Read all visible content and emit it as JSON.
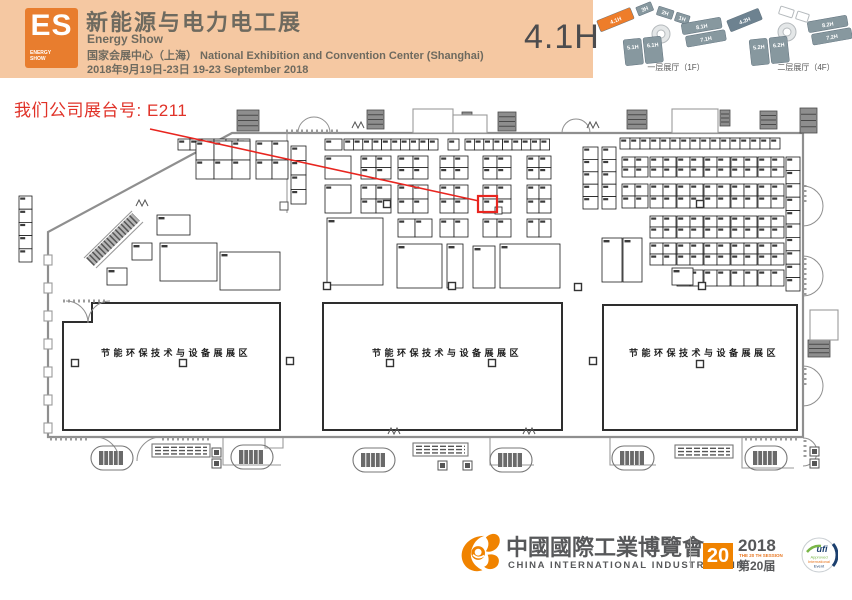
{
  "header": {
    "logo": {
      "es": "ES",
      "energy": "ENERGY",
      "show": "SHOW"
    },
    "title_cn": "新能源与电力电工展",
    "title_en": "Energy Show",
    "venue": "国家会展中心（上海） National Exhibition and Convention Center (Shanghai)",
    "dates": "2018年9月19日-23日    19-23 September 2018",
    "hall": "4.1H",
    "minimap1": {
      "label": "一层展厅（1F）",
      "h1": "1H",
      "h2": "2H",
      "h3": "3H",
      "h41": "4.1H",
      "h51": "5.1H",
      "h61": "6.1H",
      "h71": "7.1H",
      "h81": "8.1H"
    },
    "minimap2": {
      "label": "二层展厅（4F）",
      "h42": "4.2H",
      "h52": "5.2H",
      "h62": "6.2H",
      "h72": "7.2H",
      "h82": "8.2H"
    }
  },
  "annotation": {
    "text": "我们公司展台号: E211",
    "booth": "E211"
  },
  "map": {
    "zone_label": "节能环保技术与设备展展区",
    "grids": [
      [
        178,
        139,
        6,
        1,
        12,
        11
      ],
      [
        325,
        139,
        1,
        1,
        17,
        11
      ],
      [
        344,
        139,
        10,
        1,
        9.4,
        11
      ],
      [
        448,
        139,
        1,
        1,
        11,
        11
      ],
      [
        465,
        139,
        9,
        1,
        9.4,
        11
      ],
      [
        620,
        138,
        16,
        1,
        10,
        11
      ],
      [
        196,
        141,
        3,
        2,
        18,
        19
      ],
      [
        256,
        141,
        2,
        2,
        16,
        19
      ],
      [
        291,
        146,
        1,
        4,
        15,
        14.5
      ],
      [
        325,
        156,
        1,
        1,
        26,
        23
      ],
      [
        361,
        156,
        2,
        2,
        15,
        11.5
      ],
      [
        398,
        156,
        2,
        2,
        15,
        11.5
      ],
      [
        440,
        156,
        2,
        2,
        14,
        11.5
      ],
      [
        483,
        156,
        2,
        2,
        14,
        11.5
      ],
      [
        527,
        156,
        2,
        2,
        12,
        11.5
      ],
      [
        325,
        185,
        1,
        1,
        26,
        28
      ],
      [
        361,
        185,
        2,
        2,
        15,
        14
      ],
      [
        398,
        185,
        2,
        2,
        15,
        14
      ],
      [
        440,
        185,
        2,
        2,
        14,
        14
      ],
      [
        483,
        185,
        2,
        2,
        14,
        14
      ],
      [
        527,
        185,
        2,
        2,
        12,
        14
      ],
      [
        398,
        219,
        2,
        1,
        17,
        18
      ],
      [
        440,
        219,
        2,
        1,
        14,
        18
      ],
      [
        483,
        219,
        2,
        1,
        14,
        18
      ],
      [
        527,
        219,
        2,
        1,
        12,
        18
      ],
      [
        583,
        147,
        1,
        5,
        15,
        12.4
      ],
      [
        602,
        147,
        1,
        5,
        14,
        12.4
      ],
      [
        786,
        157,
        1,
        10,
        14,
        13.4
      ],
      [
        19,
        196,
        1,
        5,
        13,
        13.2
      ]
    ],
    "rgrid": {
      "xs": [
        622,
        650,
        677,
        704,
        731,
        758
      ],
      "cw": 13,
      "bands": [
        {
          "y": 157,
          "rows": 2,
          "ch": 10,
          "from": 0
        },
        {
          "y": 184,
          "rows": 2,
          "ch": 12,
          "from": 0
        },
        {
          "y": 216,
          "rows": 2,
          "ch": 11,
          "from": 1
        },
        {
          "y": 243,
          "rows": 2,
          "ch": 11,
          "from": 1
        },
        {
          "y": 270,
          "rows": 1,
          "ch": 16,
          "from": 2
        }
      ]
    },
    "bigs": [
      [
        157,
        215,
        33,
        20
      ],
      [
        132,
        243,
        20,
        17
      ],
      [
        160,
        243,
        57,
        38
      ],
      [
        107,
        268,
        20,
        17
      ],
      [
        220,
        252,
        60,
        38
      ],
      [
        327,
        218,
        56,
        67
      ],
      [
        397,
        244,
        45,
        44
      ],
      [
        447,
        244,
        16,
        44
      ],
      [
        473,
        246,
        22,
        42
      ],
      [
        500,
        244,
        60,
        44
      ],
      [
        602,
        238,
        20,
        44
      ],
      [
        623,
        238,
        19,
        44
      ],
      [
        672,
        268,
        21,
        17
      ]
    ],
    "pillars": [
      [
        387,
        204
      ],
      [
        700,
        204
      ],
      [
        327,
        286
      ],
      [
        452,
        286
      ],
      [
        578,
        287
      ],
      [
        702,
        286
      ],
      [
        290,
        361
      ],
      [
        593,
        361
      ],
      [
        75,
        363
      ],
      [
        183,
        363
      ],
      [
        390,
        363
      ],
      [
        492,
        363
      ],
      [
        700,
        364
      ]
    ],
    "escalators": [
      [
        112,
        458
      ],
      [
        252,
        457
      ],
      [
        374,
        460
      ],
      [
        511,
        460
      ],
      [
        633,
        458
      ],
      [
        766,
        458
      ]
    ],
    "walkways": [
      [
        152,
        444,
        58
      ],
      [
        413,
        443,
        55
      ],
      [
        675,
        445,
        58
      ]
    ],
    "darks": [
      [
        237,
        110,
        22,
        21
      ],
      [
        367,
        110,
        17,
        19
      ],
      [
        462,
        112,
        10,
        14
      ],
      [
        498,
        112,
        18,
        19
      ],
      [
        627,
        110,
        20,
        19
      ],
      [
        720,
        110,
        10,
        16
      ],
      [
        760,
        111,
        17,
        18
      ],
      [
        800,
        108,
        17,
        25
      ],
      [
        808,
        340,
        22,
        17
      ]
    ],
    "rooms": [
      [
        413,
        109,
        40,
        24
      ],
      [
        453,
        115,
        34,
        18
      ],
      [
        672,
        109,
        46,
        24
      ],
      [
        810,
        310,
        28,
        30
      ]
    ],
    "sqmarks": [
      [
        212,
        448
      ],
      [
        212,
        459
      ],
      [
        438,
        461
      ],
      [
        463,
        461
      ],
      [
        810,
        447
      ],
      [
        810,
        459
      ]
    ],
    "scallops": [
      [
        50,
        439,
        88,
        439
      ],
      [
        162,
        439,
        210,
        439
      ],
      [
        745,
        439,
        800,
        439
      ],
      [
        286,
        131,
        340,
        131
      ],
      [
        63,
        301,
        108,
        301
      ],
      [
        805,
        185,
        805,
        205
      ],
      [
        805,
        258,
        805,
        298
      ],
      [
        805,
        368,
        805,
        388
      ],
      [
        805,
        440,
        805,
        460
      ]
    ],
    "arcs": [
      "M95,437 a24,24 0 0 1 24,24 M161,437 a24,24 0 0 0 -24,24",
      "M298,133 a16,16 0 0 1 16,-16 M330,133 a16,16 0 0 0 -16,-16",
      "M562,133 a14,14 0 0 1 14,-14 M590,133 a14,14 0 0 0 -14,-14",
      "M803,186 a20,20 0 0 1 20,20 M803,226 a20,20 0 0 0 20,-20",
      "M803,256 a20,20 0 0 1 20,20 M803,296 a20,20 0 0 0 20,-20",
      "M803,366 a20,20 0 0 1 20,20 M803,406 a20,20 0 0 0 20,-20",
      "M803,438 a14,14 0 0 1 14,14 M803,466 a14,14 0 0 0 14,-14",
      "M66,301 a22,22 0 0 1 22,22 M110,301 a22,22 0 0 0 -22,22"
    ],
    "zigzags": [
      [
        352,
        128
      ],
      [
        587,
        128
      ],
      [
        388,
        434
      ],
      [
        523,
        434
      ],
      [
        136,
        206
      ]
    ],
    "lpaths": [
      "M223,438 v27 h58",
      "M490,438 v27 h44",
      "M610,438 v27 h46",
      "M742,438 v30 h52",
      "M265,438 v10 h18 v-10"
    ],
    "crenels": [
      255,
      283,
      311,
      339,
      367,
      395,
      423
    ]
  },
  "footer": {
    "fair_cn": "中國國際工業博覽會",
    "fair_en": "CHINA INTERNATIONAL INDUSTRY FAIR",
    "badge_num": "20",
    "year": "2018",
    "session_en": "THE 20 TH SESSION",
    "session_cn": "第20届",
    "ufi_text": "ufi",
    "ufi_sub1": "Approved",
    "ufi_sub2": "International",
    "ufi_sub3": "Event"
  },
  "colors": {
    "header_bg": "#f5c8a2",
    "logo_orange": "#e87d2e",
    "accent_red": "#e8251f",
    "fair_orange": "#f08300",
    "slate": "#87989f",
    "slate_dark": "#6d8290"
  }
}
